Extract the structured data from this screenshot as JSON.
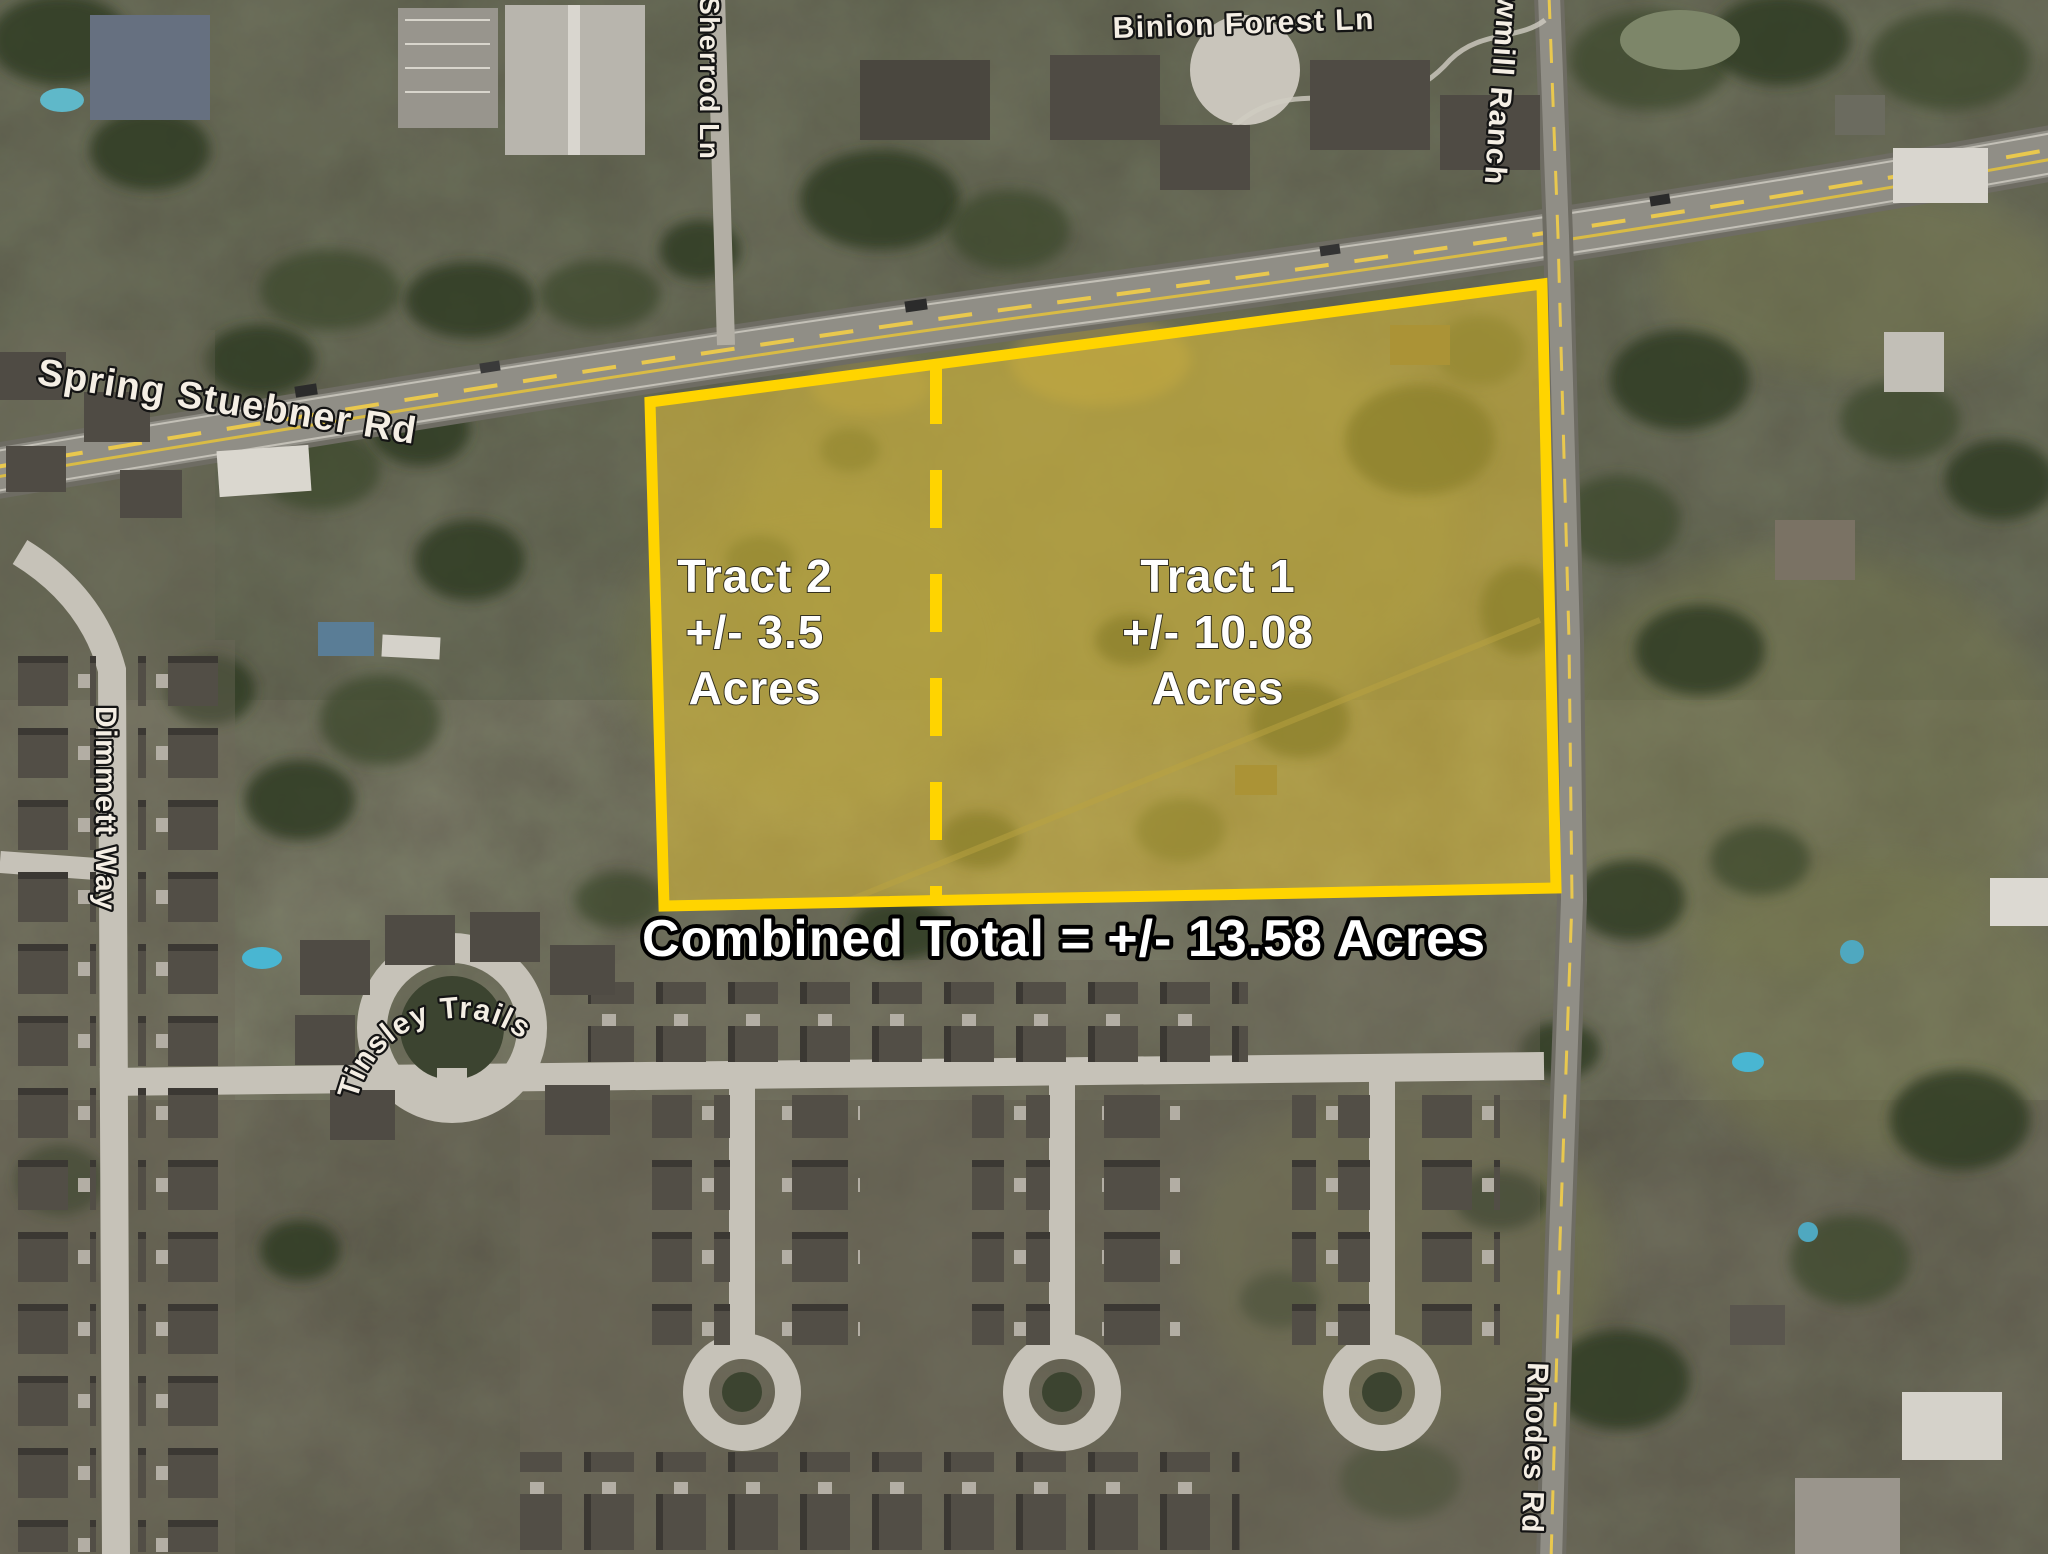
{
  "labels": {
    "tract2": {
      "title": "Tract 2",
      "acreage": "+/- 3.5",
      "unit": "Acres"
    },
    "tract1": {
      "title": "Tract 1",
      "acreage": "+/- 10.08",
      "unit": "Acres"
    },
    "combined_total": "Combined Total = +/- 13.58 Acres"
  },
  "roads": {
    "spring_stuebner_rd": "Spring Stuebner Rd",
    "sherrod_ln": "Sherrod Ln",
    "binion_forest_ln": "Binion Forest Ln",
    "sawmill_ranch": "wmill Ranch",
    "dimmett_way": "Dimmett Way",
    "tinsley_trails": "Tinsley Trails",
    "rhodes_rd": "Rhodes Rd"
  },
  "colors": {
    "highlight": "#FFD400",
    "overlay_fill": "#E6C437",
    "label_white": "#FFFFFF",
    "outline_black": "#000000"
  }
}
